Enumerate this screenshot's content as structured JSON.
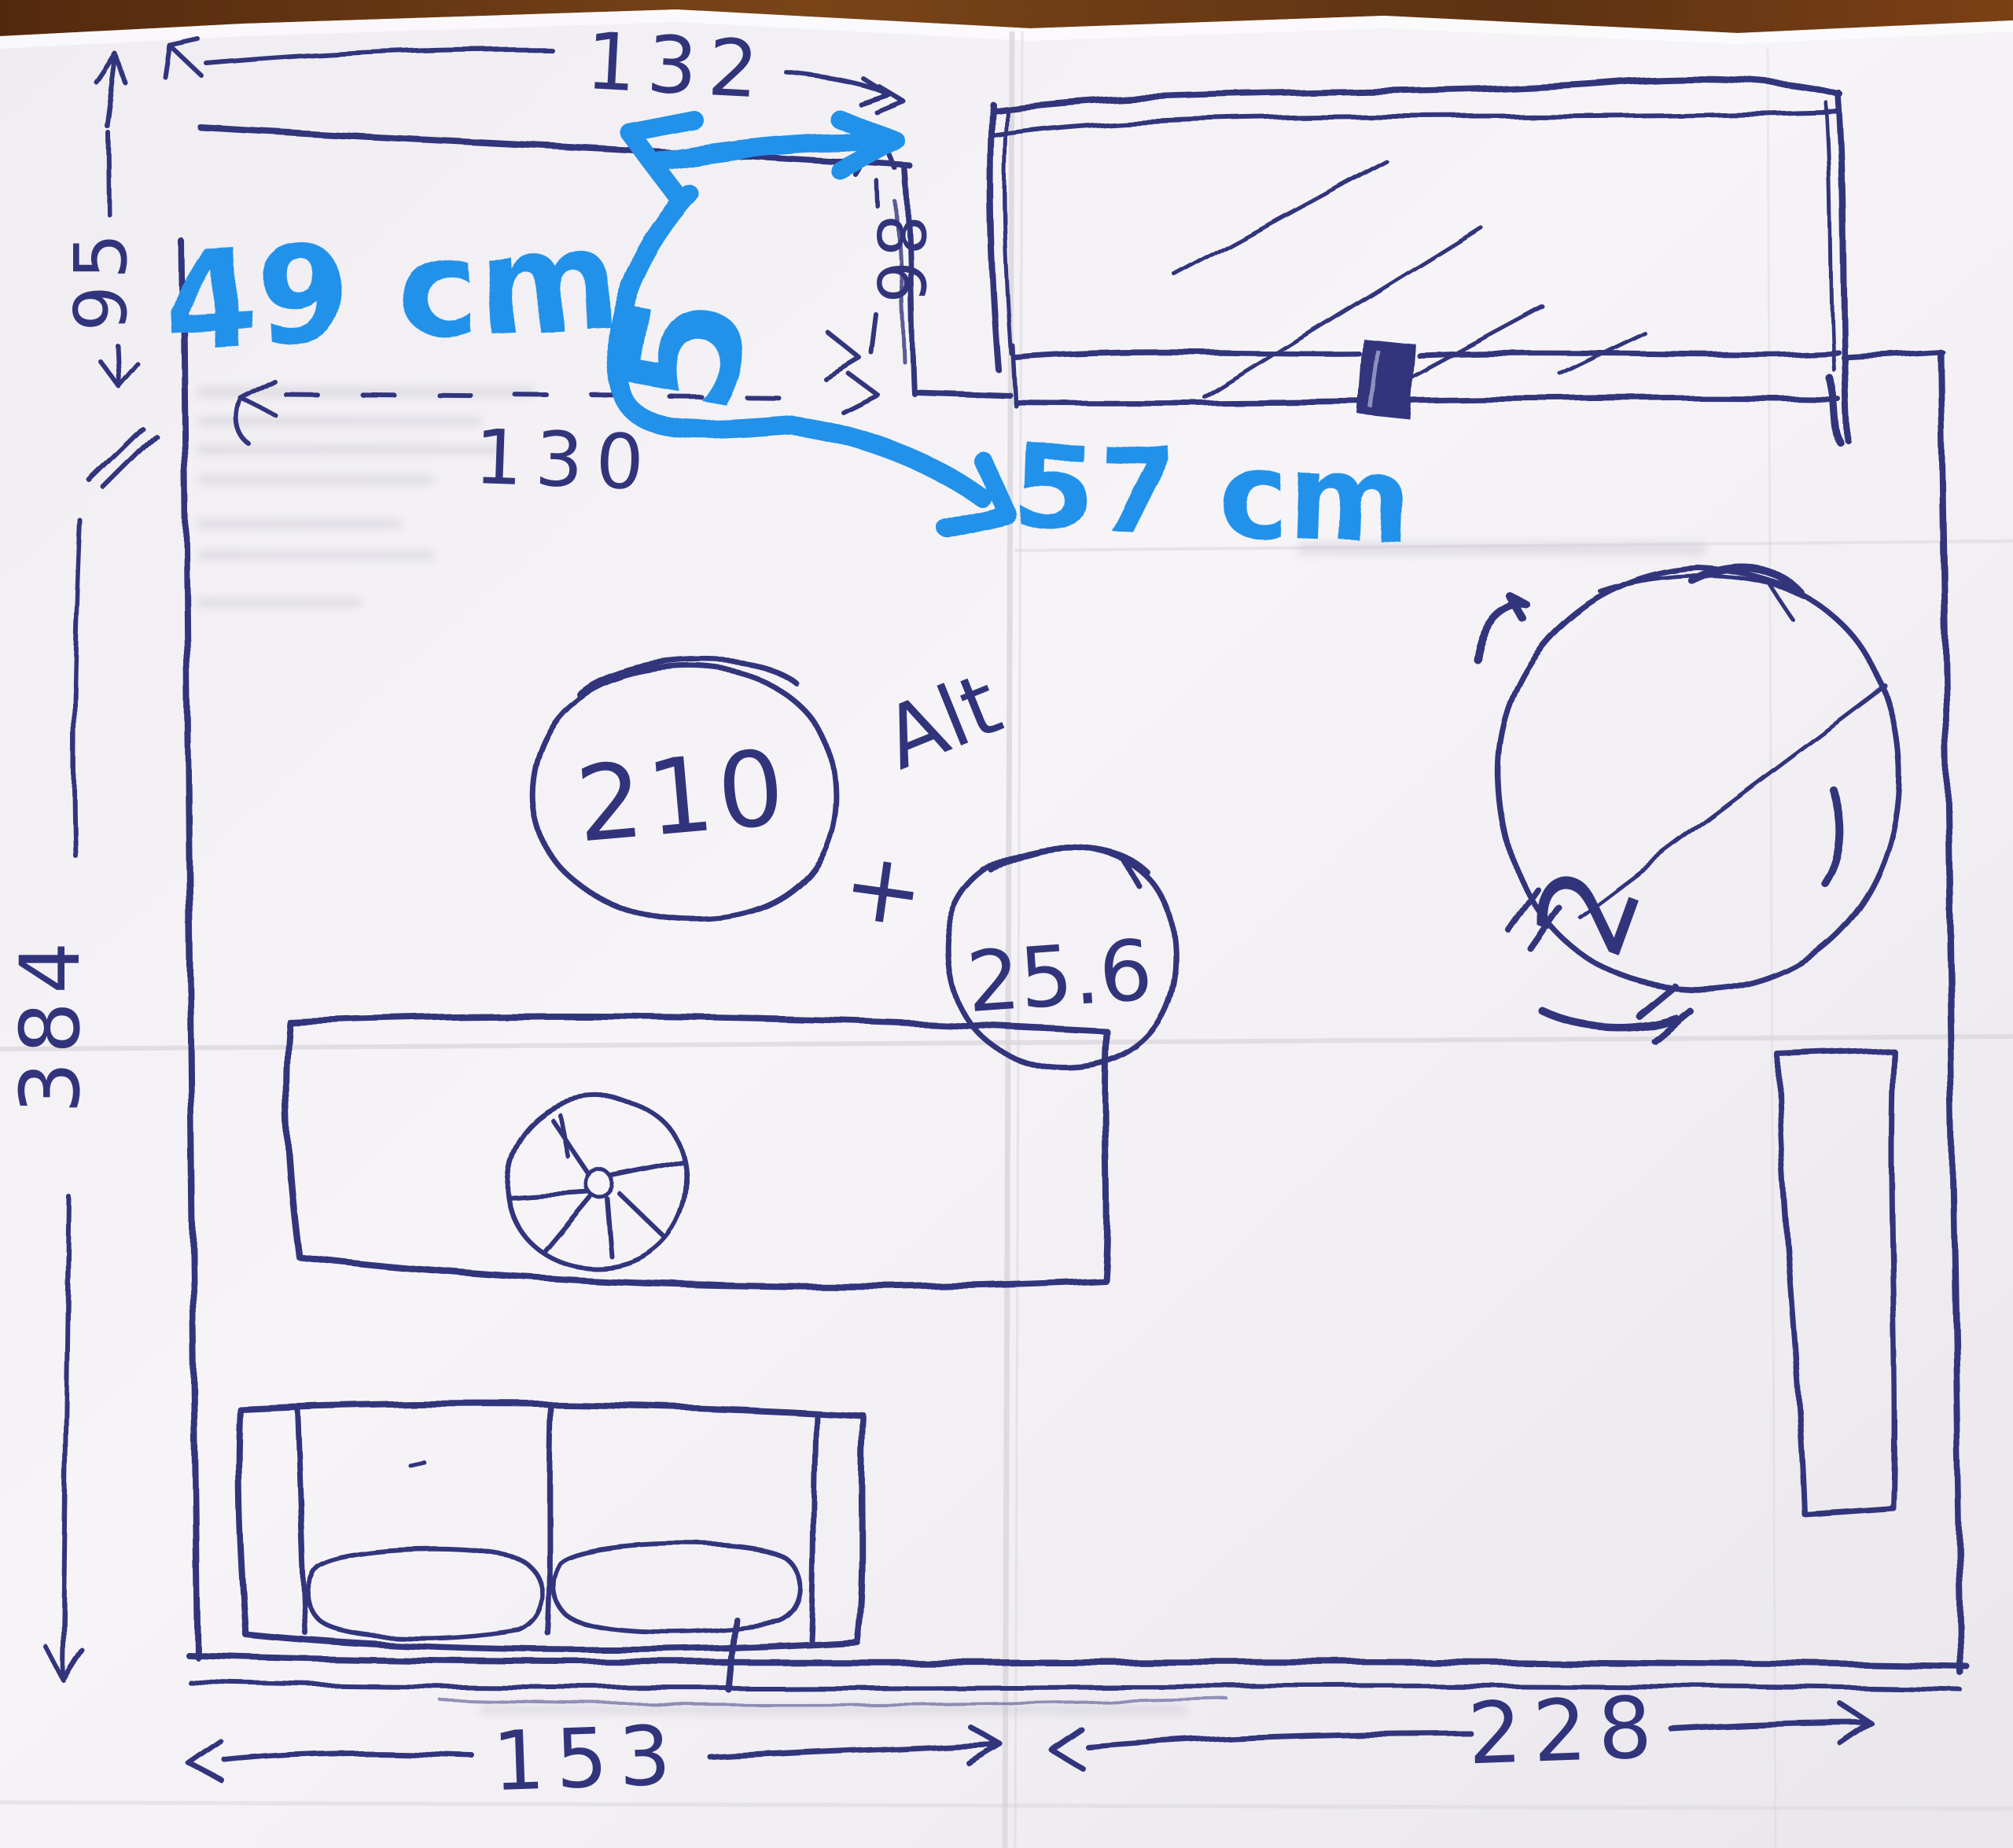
{
  "annotations_pen": {
    "dim_top_width": "132",
    "dim_left_upper": "95",
    "dim_window_side": "86",
    "dim_alcove_width": "130",
    "dim_left_full": "384",
    "dim_bottom_left": "153",
    "dim_bottom_right": "228",
    "calc_value_circled_1": "210",
    "calc_label": "Alt",
    "calc_operator": "+",
    "calc_value_circled_2": "25.6",
    "calc_result": "2"
  },
  "annotations_marker": {
    "note_width": "49 cm",
    "digit": "5",
    "note_depth": "57 cm"
  },
  "colors": {
    "pen": "#32347b",
    "pen_dark": "#23255c",
    "marker": "#2191e9",
    "paper": "#f4f2f5",
    "wood": "#6a3a16"
  }
}
